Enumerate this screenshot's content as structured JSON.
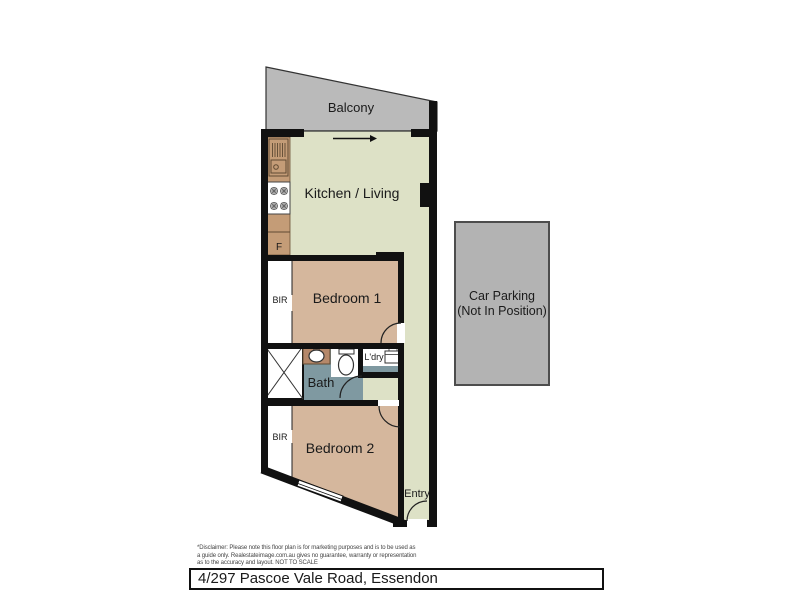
{
  "floorplan": {
    "labels": {
      "balcony": "Balcony",
      "kitchen_living": "Kitchen / Living",
      "bedroom1": "Bedroom 1",
      "bedroom2": "Bedroom 2",
      "bath": "Bath",
      "laundry": "L'dry",
      "entry": "Entry",
      "bir1": "BIR",
      "bir2": "BIR",
      "fridge": "F"
    },
    "car_parking": {
      "line1": "Car Parking",
      "line2": "(Not In Position)"
    },
    "colors": {
      "living_area": "#dde1c6",
      "bedroom": "#d5b79d",
      "bath": "#7f99a1",
      "laundry_floor": "#7f99a1",
      "balcony": "#bababa",
      "car_parking": "#b3b3b3",
      "counter": "#c49c77",
      "basin_counter": "#b5886a",
      "wall": "#111111",
      "fixture_outline": "#5f4a33"
    }
  },
  "footer": {
    "disclaimer": {
      "line1": "*Disclaimer: Please note this floor plan is for marketing purposes and is to be used as",
      "line2": "a guide only. Realestateimage.com.au gives no guarantee, warranty or representation",
      "line3": "as to the accuracy and layout. NOT TO SCALE"
    },
    "address": "4/297 Pascoe Vale Road, Essendon"
  }
}
